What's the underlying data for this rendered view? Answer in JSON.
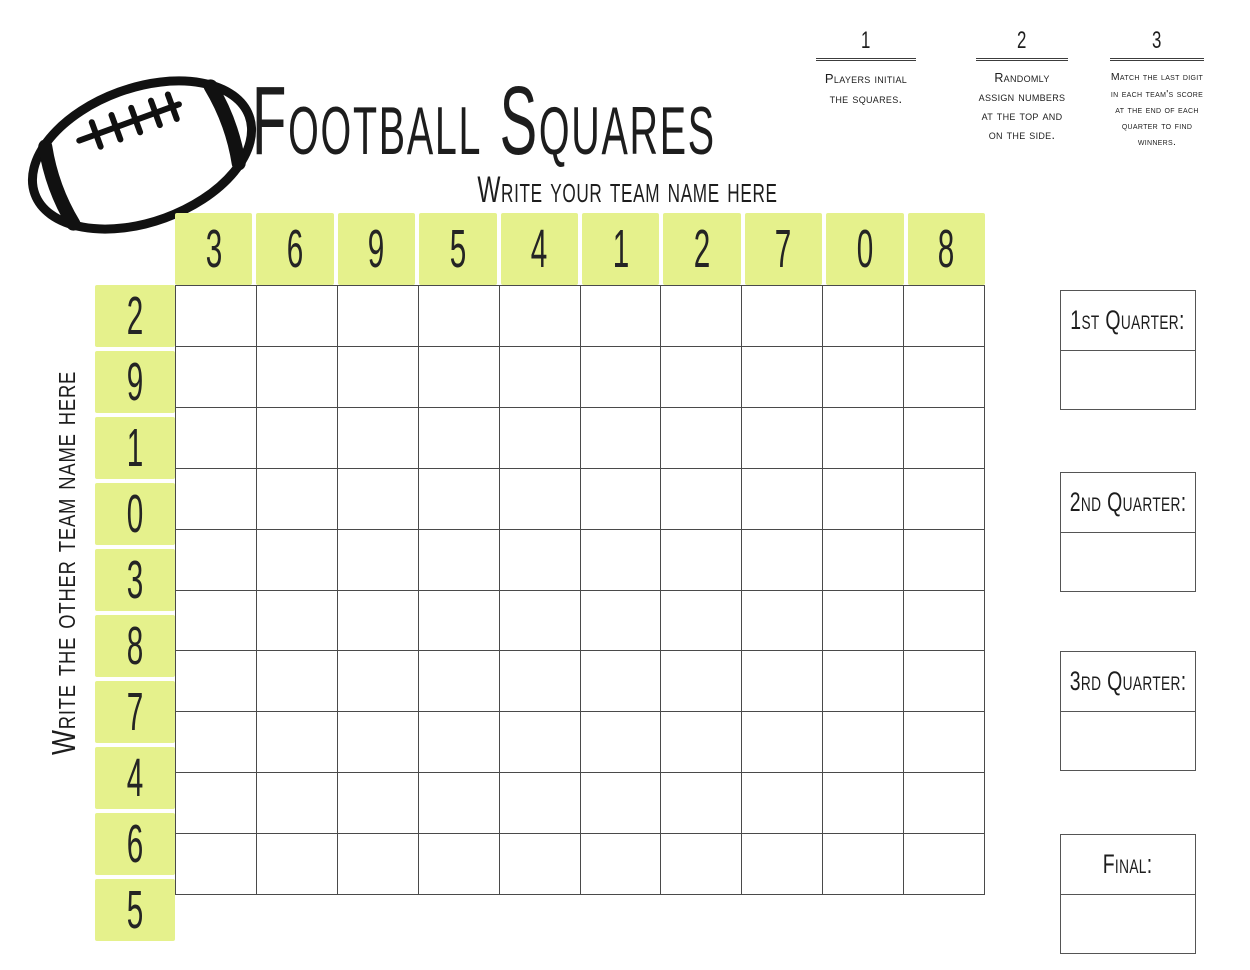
{
  "title": "Football Squares",
  "subtitle": "Write your team name here",
  "side_label": "Write the other team name here",
  "steps": [
    {
      "number": "1",
      "text": "Players initial the squares."
    },
    {
      "number": "2",
      "text": "Randomly assign numbers at the top and on the side."
    },
    {
      "number": "3",
      "text": "Match the last digit in each team's score at the end of each quarter to find winners."
    }
  ],
  "grid": {
    "rows": 10,
    "cols": 10,
    "top_numbers": [
      "3",
      "6",
      "9",
      "5",
      "4",
      "1",
      "2",
      "7",
      "0",
      "8"
    ],
    "side_numbers": [
      "2",
      "9",
      "1",
      "0",
      "3",
      "8",
      "7",
      "4",
      "6",
      "5"
    ]
  },
  "score_boxes": [
    {
      "label": "1st Quarter:"
    },
    {
      "label": "2nd Quarter:"
    },
    {
      "label": "3rd Quarter:"
    },
    {
      "label": "Final:"
    }
  ],
  "colors": {
    "highlight": "#e5f18c",
    "grid_line": "#4a4a4a",
    "box_border": "#555555",
    "ink": "#1d1d1d"
  }
}
